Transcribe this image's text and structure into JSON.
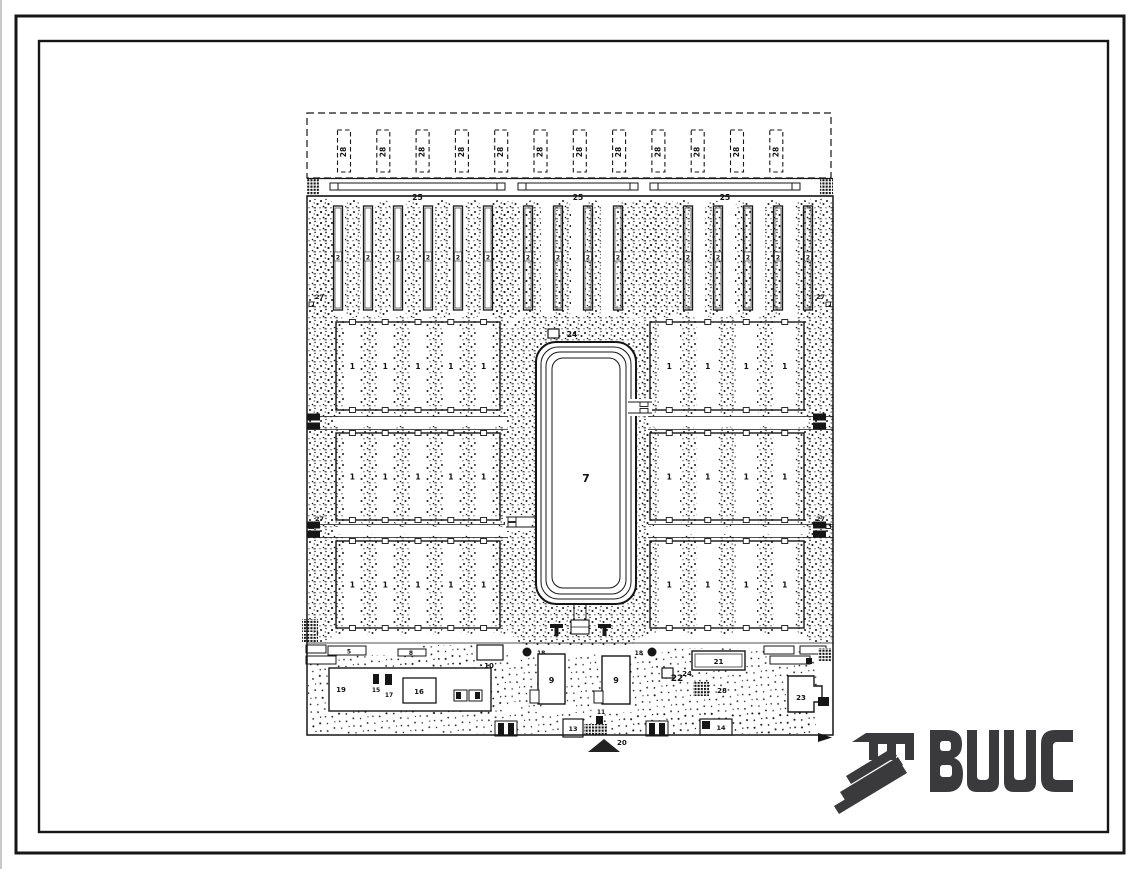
{
  "watermark": {
    "text": "ВЦИС",
    "color": "#3a3a3c"
  },
  "drawing": {
    "ink_color": "#161616",
    "labels": {
      "barn": "1",
      "calf_shed": "2",
      "bar5": "5",
      "pond": "7",
      "bar8": "8",
      "building9": "9",
      "building10": "10",
      "building11": "11",
      "gate13": "13",
      "building14": "14",
      "item15": "15",
      "building16": "16",
      "item17": "17",
      "well18": "18",
      "building19": "19",
      "sign20": "20",
      "building21": "21",
      "area22": "22",
      "building23": "23",
      "square24": "24",
      "strip25": "25",
      "edge27": "27",
      "plot28": "28",
      "hatch_square28": "28"
    },
    "counts": {
      "expansion_plots": 12,
      "road_strips": 3,
      "calf_shed_groups": [
        6,
        4,
        5
      ],
      "barn_rows_per_side": 3,
      "barns_per_row_left": 5,
      "barns_per_row_right": 4,
      "pond_outline_rings": 4,
      "edge_mark_27": 4,
      "wells_18": 2,
      "buildings_9": 2
    }
  }
}
